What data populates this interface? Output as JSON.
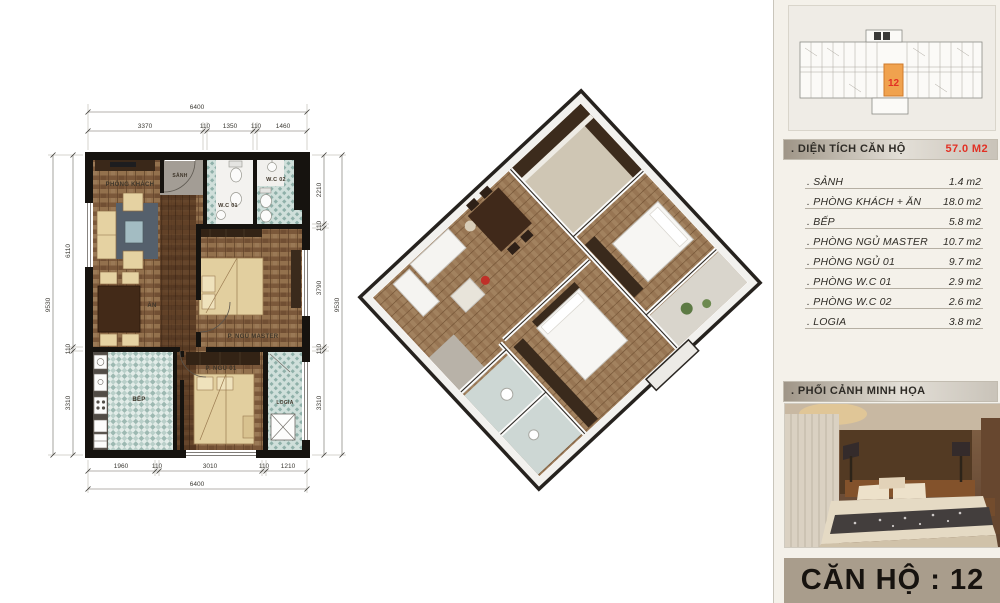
{
  "overview": {
    "unit_number": "12"
  },
  "panel": {
    "area_header": {
      "label": ". DIỆN TÍCH CĂN HỘ",
      "value": "57.0 M2"
    },
    "rooms": [
      {
        "label": ". SẢNH",
        "value": "1.4 m2"
      },
      {
        "label": ". PHÒNG KHÁCH + ĂN",
        "value": "18.0 m2"
      },
      {
        "label": ". BẾP",
        "value": "5.8 m2"
      },
      {
        "label": ". PHÒNG NGỦ MASTER",
        "value": "10.7 m2"
      },
      {
        "label": ". PHÒNG NGỦ 01",
        "value": "9.7 m2"
      },
      {
        "label": ". PHÒNG W.C 01",
        "value": "2.9 m2"
      },
      {
        "label": ". PHÒNG W.C 02",
        "value": "2.6 m2"
      },
      {
        "label": ". LOGIA",
        "value": "3.8 m2"
      }
    ],
    "photo_header": ". PHỐI CẢNH MINH HỌA",
    "unit_title": "CĂN HỘ : 12"
  },
  "floor_plan": {
    "labels": {
      "living": "PHÒNG KHÁCH",
      "hall": "SẢNH",
      "wc1": "W.C 01",
      "wc2": "W.C 02",
      "dining": "ĂN",
      "master": "P. NGỦ MASTER",
      "kitchen": "BẾP",
      "bedroom1": "P. NGỦ 01",
      "logia": "LOGIA"
    },
    "dims": {
      "top_total": "6400",
      "top_segments": [
        "3370",
        "110",
        "1350",
        "110",
        "1460"
      ],
      "left_overall": "9530",
      "left_segments": [
        "6110",
        "110",
        "3310"
      ],
      "right_segments": [
        "2210",
        "110",
        "3790",
        "110",
        "3310"
      ],
      "right_overall": "9530",
      "bottom_segments": [
        "1960",
        "110",
        "3010",
        "110",
        "1210"
      ],
      "bottom_total": "6400"
    }
  },
  "colors": {
    "accent_red": "#e23024",
    "unit_highlight": "#f0a24e",
    "band_bg": "#a99d8c",
    "tile_teal": "#9db9b2",
    "wood": "#8a6847"
  }
}
